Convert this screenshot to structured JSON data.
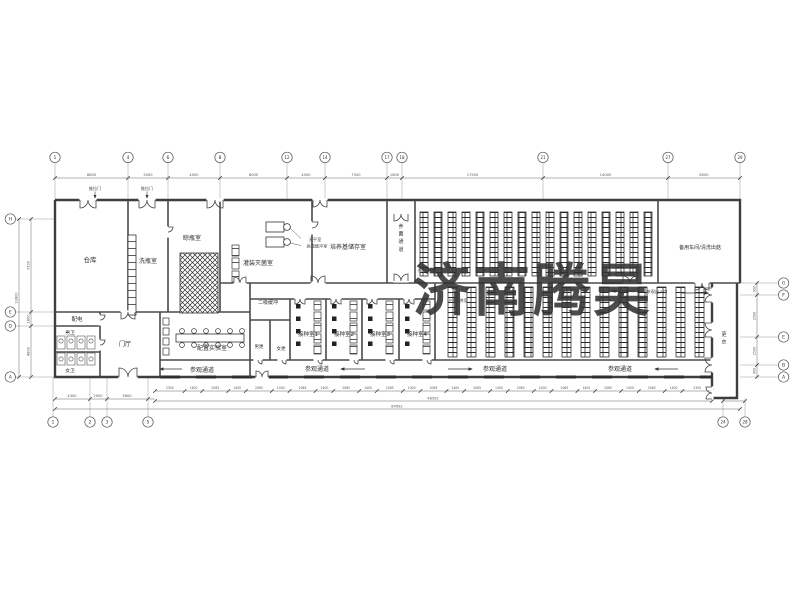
{
  "watermark": {
    "text": "济南腾昊",
    "color": "#e5484f"
  },
  "rooms": {
    "warehouse": "仓库",
    "bottle_washing": "洗瓶室",
    "bottle_drying": "晾瓶室",
    "filling_sterilizing": "灌装灭菌室",
    "medium_storage": "培养基储存室",
    "incubation_corridor": "养菌通道",
    "spare_workshop": "备用车间/清洗出菇",
    "secondary_buffer": "二级缓冲",
    "inoculation_1": "接种室1",
    "inoculation_2": "接种室2",
    "inoculation_3": "接种室3",
    "inoculation_4": "接种室4",
    "power_room": "配电",
    "mens_wc": "男卫",
    "womens_wc": "女卫",
    "foyer": "门厅",
    "prep_lab": "配置实验室",
    "mens_changing": "男更",
    "womens_changing": "女更",
    "changing_room": "更衣",
    "light_culture": "光照培养室"
  },
  "annotations": {
    "sliding_door": "推拉门",
    "visit_corridor": "参观通道",
    "visit_entrance": "参观出入口",
    "balance_room": "天平室",
    "high_temp_buffer": "高温缓冲室"
  },
  "grid": {
    "top": [
      "1",
      "4",
      "6",
      "8",
      "12",
      "14",
      "17",
      "18",
      "21",
      "27",
      "29"
    ],
    "bottom": [
      "1",
      "2",
      "3",
      "5",
      "24",
      "28"
    ],
    "left": [
      "H",
      "E",
      "D",
      "A"
    ],
    "right": [
      "G",
      "F",
      "E",
      "B",
      "A"
    ]
  },
  "dims": {
    "top": [
      "8800",
      "5000",
      "4000",
      "8000",
      "4500",
      "7500",
      "1800",
      "17500",
      "14000",
      "8000"
    ],
    "bottom_left": [
      "4300",
      "2000",
      "5600"
    ],
    "bottom_chain": [
      "2350",
      "1400",
      "2065",
      "1400",
      "2065",
      "1400",
      "2065",
      "1400",
      "2065",
      "1400",
      "2065",
      "1400",
      "2065",
      "1400",
      "2065",
      "1400",
      "2065",
      "1400",
      "2065",
      "1400",
      "2065",
      "1400",
      "2065",
      "1400",
      "2350"
    ],
    "subtotal": "48592",
    "total": "84592",
    "left": [
      "7200",
      "1800",
      "4800"
    ],
    "left_total": "13800",
    "right": [
      "900",
      "2500",
      "2500",
      "900"
    ],
    "right_bottom": "2000"
  }
}
